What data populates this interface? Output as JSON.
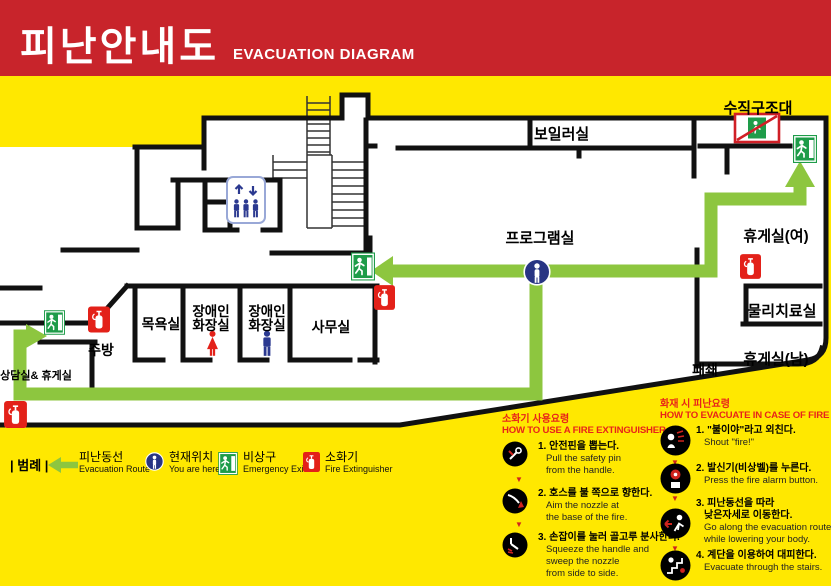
{
  "header": {
    "title_ko": "피난안내도",
    "title_en": "EVACUATION DIAGRAM"
  },
  "plan": {
    "labels": {
      "vertical_rescue": "수직구조대",
      "boiler": "보일러실",
      "program": "프로그램실",
      "lounge_women": "휴게실(여)",
      "physio": "물리치료실",
      "lounge_men": "휴게실(남)",
      "closed": "패쇄",
      "office": "사무실",
      "bath": "목욕실",
      "accessible_toilet_line1": "장애인",
      "accessible_toilet_line2": "화장실",
      "kitchen": "주방",
      "counseling": "상담실& 휴게실"
    }
  },
  "legend": {
    "title": "| 범례 |",
    "items": [
      {
        "ko": "피난동선",
        "en": "Evacuation Route"
      },
      {
        "ko": "현재위치",
        "en": "You are here"
      },
      {
        "ko": "비상구",
        "en": "Emergency Exit"
      },
      {
        "ko": "소화기",
        "en": "Fire Extinguisher"
      }
    ]
  },
  "extinguisher_guide": {
    "title_ko": "소화기 사용요령",
    "title_en": "HOW TO USE A FIRE EXTINGUISHER",
    "steps": [
      {
        "ko": "1. 안전핀을 뽑는다.",
        "en": [
          "Pull the safety pin",
          "from the handle."
        ]
      },
      {
        "ko": "2. 호스를 불 쪽으로 향한다.",
        "en": [
          "Aim the nozzle at",
          "the base of the fire."
        ]
      },
      {
        "ko": "3. 손잡이를 눌러 골고루 분사한다.",
        "en": [
          "Squeeze the handle and",
          "sweep the nozzle",
          "from side to side."
        ]
      }
    ]
  },
  "evacuation_guide": {
    "title_ko": "화재 시 피난요령",
    "title_en": "HOW TO EVACUATE IN CASE OF FIRE",
    "steps": [
      {
        "ko": [
          "1. \"불이야\"라고 외친다."
        ],
        "en": [
          "Shout \"fire!\""
        ]
      },
      {
        "ko": [
          "2. 발신기(비상벨)를 누른다."
        ],
        "en": [
          "Press the fire alarm button."
        ]
      },
      {
        "ko": [
          "3. 피난동선을 따라",
          "낮은자세로 이동한다."
        ],
        "en": [
          "Go along the evacuation route",
          "while lowering your body."
        ]
      },
      {
        "ko": [
          "4. 계단을 이용하여 대피한다."
        ],
        "en": [
          "Evacuate through the stairs."
        ]
      }
    ]
  },
  "colors": {
    "header_red": "#C8242B",
    "background_yellow": "#FFE800",
    "route_green": "#8DC63F",
    "exit_green": "#1E9C49",
    "alarm_red": "#E32119",
    "here_blue": "#283583",
    "man_blue": "#2B3990",
    "woman_red": "#E32119"
  }
}
